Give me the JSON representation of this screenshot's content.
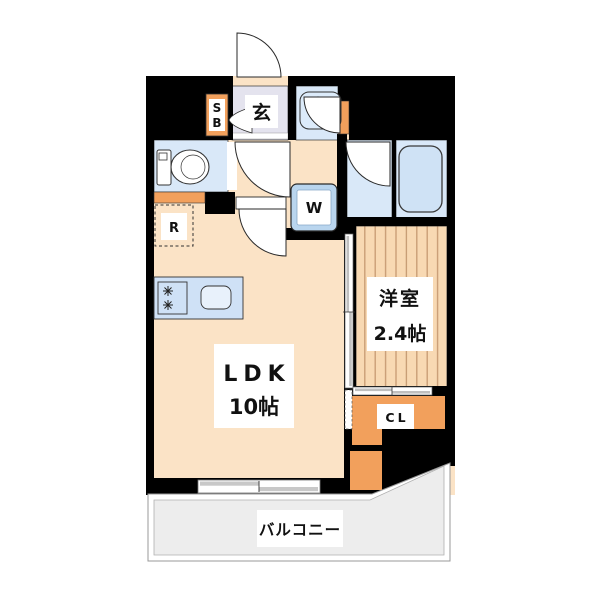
{
  "plan": {
    "type": "apartment-floor-plan",
    "rooms": {
      "ldk": {
        "label": "LDK",
        "size": "10帖"
      },
      "western": {
        "label": "洋室",
        "size": "2.4帖"
      },
      "entrance": {
        "label": "玄"
      },
      "closet": {
        "label": "CL"
      },
      "balcony": {
        "label": "バルコニー"
      },
      "shoe_box": {
        "lines": [
          "S",
          "B"
        ]
      },
      "washer": {
        "label": "W"
      },
      "fridge": {
        "label": "R"
      }
    },
    "colors": {
      "wall": "#000000",
      "ldk_floor": "#fbe3c6",
      "entrance_floor": "#e4e3ee",
      "wet_floor": "#d9e8f8",
      "western_floor": "#f8d9b3",
      "western_stripe": "#c69a72",
      "closet_floor": "#f2a05c",
      "balcony_floor": "#ededed",
      "fixture_fill": "#cfe2f5",
      "counter_fill": "#cfe1f6",
      "label_bg": "#ffffff"
    }
  }
}
